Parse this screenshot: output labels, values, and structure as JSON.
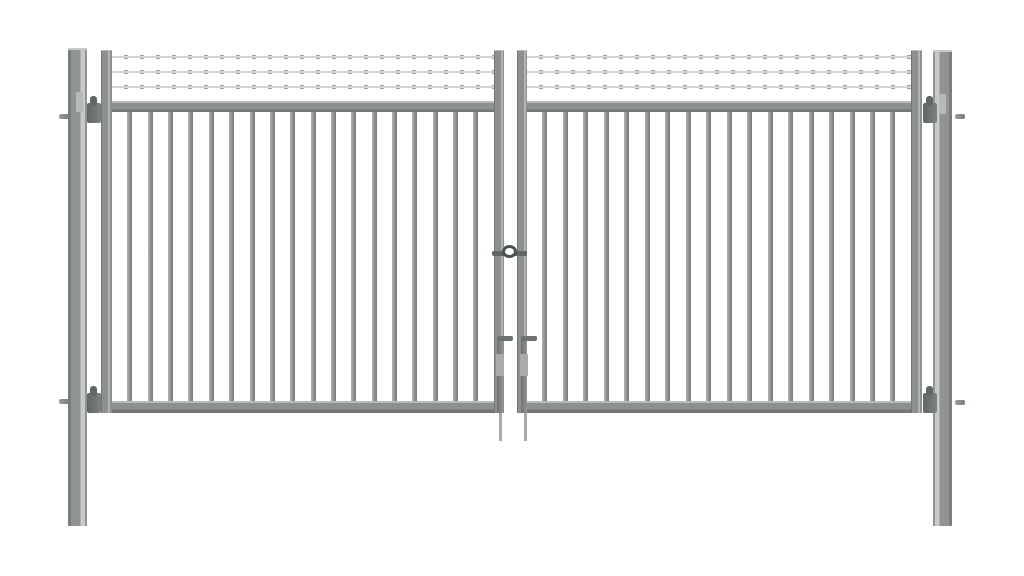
{
  "scene": {
    "description": "3D product render of a grey double-leaf metal swing gate: two square ground posts, two gate leaves with vertical bar infill, three strands of barbed wire across the raised top section, a centre padlock eye between the leaves and two L-handled drop bolts",
    "background": "#ffffff"
  },
  "colors": {
    "frame_base": "#8d9090",
    "frame_highlight": "#b9bcbc",
    "frame_shadow": "#747777",
    "bar_light": "#b2b5b5",
    "bar_mid": "#939696",
    "bar_dark": "#767979",
    "post_face": "#919494",
    "post_shadow": "#7b7e7e",
    "post_highlight": "#c7caca",
    "wire": "#d3d5d5",
    "wire_clip": "#9da0a0",
    "hardware_dark": "#636666",
    "lock_ring": "#4e5151",
    "rod_light": "#a8abab"
  },
  "gate": {
    "leaves": 2,
    "posts": 2,
    "bars_per_leaf": 18,
    "bar_width_px": 5,
    "wires_per_leaf": 3,
    "wire_clip_pitch_px": 16,
    "wire_clip_width_px": 4,
    "hinges_per_leaf": 2,
    "drop_bolts": 2,
    "lock_type": "padlock-eye"
  }
}
